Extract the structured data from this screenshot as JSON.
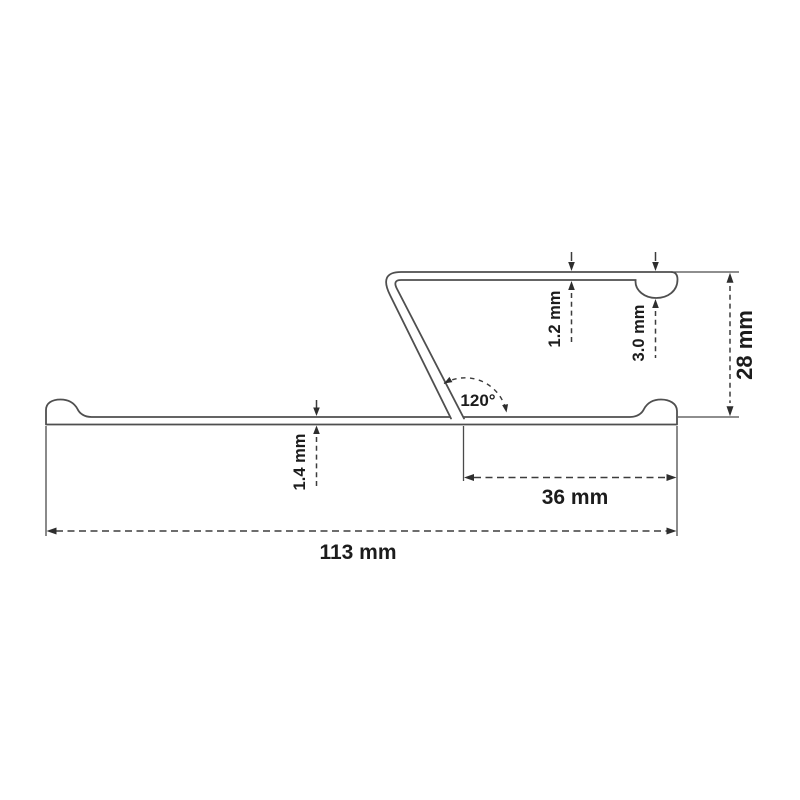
{
  "diagram": {
    "type": "technical-profile-cross-section",
    "background_color": "#ffffff",
    "line_color": "#4f4f4f",
    "dimension_line_color": "#3d3d3d",
    "text_color": "#1c1c1c",
    "labels": {
      "overall_width": "113 mm",
      "flange_width": "36 mm",
      "overall_height": "28 mm",
      "top_wall_thickness": "1.2 mm",
      "end_bead_height": "3.0 mm",
      "base_thickness": "1.4 mm",
      "bend_angle": "120°"
    },
    "values": {
      "overall_width_mm": 113,
      "flange_width_mm": 36,
      "overall_height_mm": 28,
      "top_wall_thickness_mm": 1.2,
      "end_bead_height_mm": 3.0,
      "base_thickness_mm": 1.4,
      "bend_angle_deg": 120
    }
  }
}
